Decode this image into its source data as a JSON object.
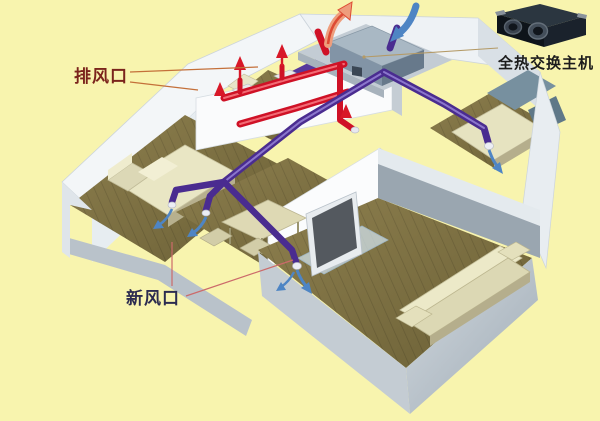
{
  "diagram": {
    "type": "isometric-cutaway-ventilation-diagram",
    "background_color": "#f8f4ae",
    "labels": {
      "exhaust_vent": "排风口",
      "fresh_air_vent": "新风口",
      "heat_exchanger_unit": "全热交换主机"
    },
    "colors": {
      "exhaust_duct_red": "#cf1126",
      "fresh_air_duct_purple": "#4a2c90",
      "fresh_airflow_arrow_blue": "#4e85c4",
      "exhaust_airflow_arrow_salmon": "#ee9d7c",
      "wood_floor": "#837748",
      "wall_white": "#f3f6f8",
      "bathroom_tile_purple": "#40237e",
      "leader_line_exhaust": "#c4703a",
      "leader_line_fresh": "#cc6a6a",
      "leader_line_unit": "#b49a66"
    }
  }
}
